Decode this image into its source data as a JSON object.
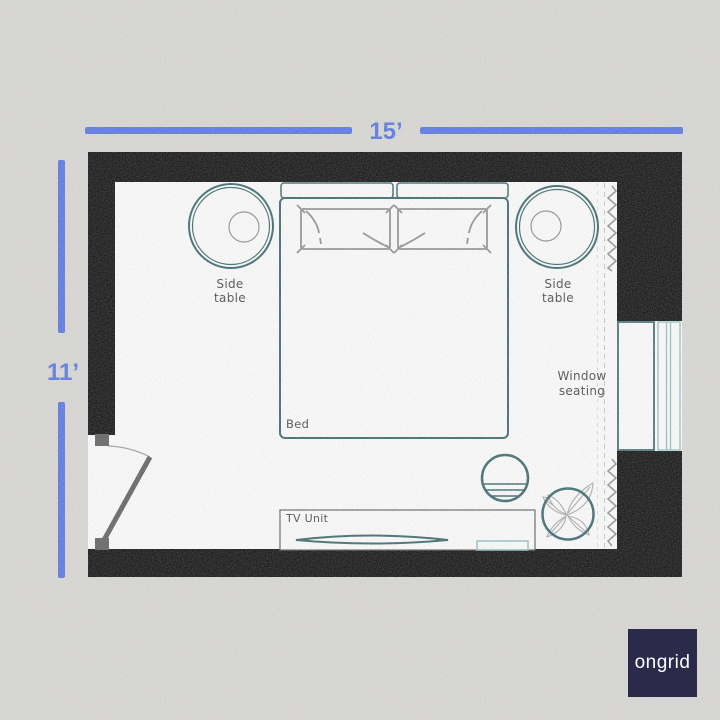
{
  "colors": {
    "background": "#d8d7d4",
    "wall": "#000000",
    "floor": "#ffffff",
    "dimension_blue": "#4c6ee2",
    "furniture_teal": "#2e5f63",
    "window_light_teal": "#8ec0c2",
    "pillow_gray": "#8a8a8a",
    "door_gray": "#575757",
    "leaf_gray": "#a6a6a6",
    "label_color": "#3d3d3d",
    "logo_background": "#2b2a4a",
    "logo_text_color": "#ffffff"
  },
  "dimensions": {
    "top_label": "15’",
    "left_label": "11’"
  },
  "labels": {
    "side_table_left": {
      "line1": "Side",
      "line2": "table"
    },
    "side_table_right": {
      "line1": "Side",
      "line2": "table"
    },
    "bed": "Bed",
    "tv_unit": "TV Unit",
    "window_seating": {
      "line1": "Window",
      "line2": "seating"
    }
  },
  "logo": {
    "text": "ongrid"
  }
}
